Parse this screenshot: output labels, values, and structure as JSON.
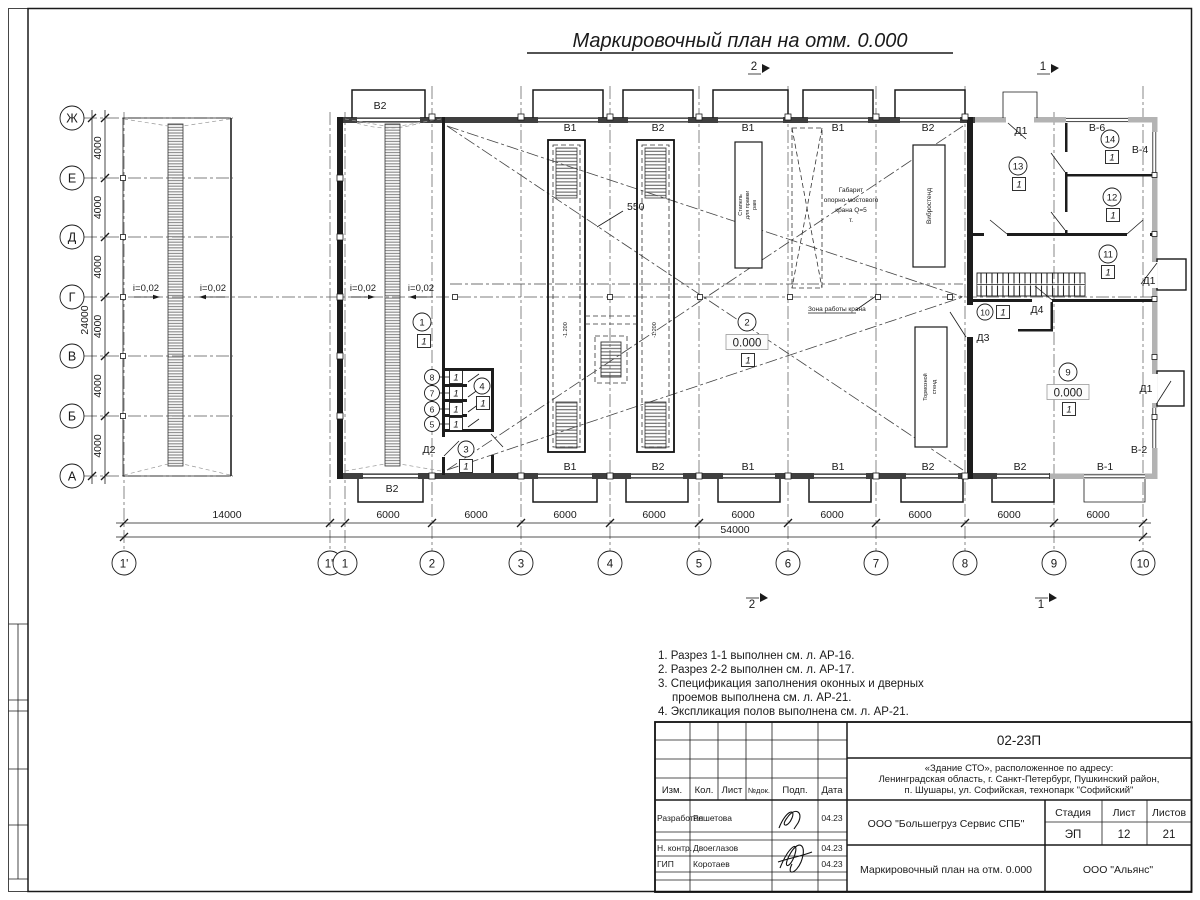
{
  "sheet": {
    "title": "Маркировочный план на отм. 0.000"
  },
  "dims": {
    "row_step": "4000",
    "row_total": "24000",
    "span14": "14000",
    "col_step": "6000",
    "col_total": "54000",
    "d550": "550"
  },
  "axes": {
    "rows": [
      "Ж",
      "Е",
      "Д",
      "Г",
      "В",
      "Б",
      "А"
    ],
    "cols": [
      "1'",
      "1\"",
      "1",
      "2",
      "3",
      "4",
      "5",
      "6",
      "7",
      "8",
      "9",
      "10"
    ]
  },
  "labels": {
    "slope": "i=0,02",
    "elev": "0.000",
    "pit_depth": "-1.200",
    "crane_zone": "Зона работы крана",
    "floor_mark": "1"
  },
  "walls": {
    "top": [
      "В1",
      "В2",
      "В1",
      "В1",
      "В2"
    ],
    "bottom": [
      "В1",
      "В2",
      "В1",
      "В1",
      "В2",
      "В2",
      "В-1"
    ],
    "canopy": "В2",
    "v6": "В-6",
    "v4": "В-4",
    "v2": "В-2"
  },
  "doors": {
    "d1": "Д1",
    "d2": "Д2",
    "d3": "Д3",
    "d4": "Д4"
  },
  "equipment": {
    "stapel": [
      "Стапель",
      "для правки",
      "рам"
    ],
    "gabarit": [
      "Габарит",
      "опорно-мостового",
      "крана Q=5",
      "т."
    ],
    "vibro": "Вибростенд",
    "brake": [
      "Тормозной",
      "стенд"
    ]
  },
  "rooms": [
    "1",
    "2",
    "3",
    "4",
    "5",
    "6",
    "7",
    "8",
    "9",
    "10",
    "11",
    "12",
    "13",
    "14"
  ],
  "sections": {
    "s1": "1",
    "s2": "2"
  },
  "notes": [
    "1. Разрез 1-1 выполнен см. л. АР-16.",
    "2. Разрез 2-2 выполнен см. л. АР-17.",
    "3. Спецификация заполнения оконных и дверных",
    "проемов выполнена см. л. АР-21.",
    "4. Экспликация полов выполнена см. л. АР-21."
  ],
  "titleblock": {
    "code": "02-23П",
    "object1": "«Здание СТО», расположенное по адресу:",
    "object2": "Ленинградская область, г. Санкт-Петербург, Пушкинский район,",
    "object3": "п. Шушары, ул. Софийская, технопарк \"Софийский\"",
    "h_izm": "Изм.",
    "h_kol": "Кол.",
    "h_list": "Лист",
    "h_ndok": "№док.",
    "h_podp": "Подп.",
    "h_data": "Дата",
    "r1_role": "Разработал",
    "r1_name": "Решетова",
    "r1_date": "04.23",
    "r2_role": "Н. контр.",
    "r2_name": "Двоеглазов",
    "r2_date": "04.23",
    "r3_role": "ГИП",
    "r3_name": "Коротаев",
    "r3_date": "04.23",
    "company": "ООО \"Большегруз Сервис СПБ\"",
    "stage_label": "Стадия",
    "list_label": "Лист",
    "listov_label": "Листов",
    "stage": "ЭП",
    "list": "12",
    "listov": "21",
    "drawing": "Маркировочный план на отм. 0.000",
    "org": "ООО \"Альянс\""
  }
}
